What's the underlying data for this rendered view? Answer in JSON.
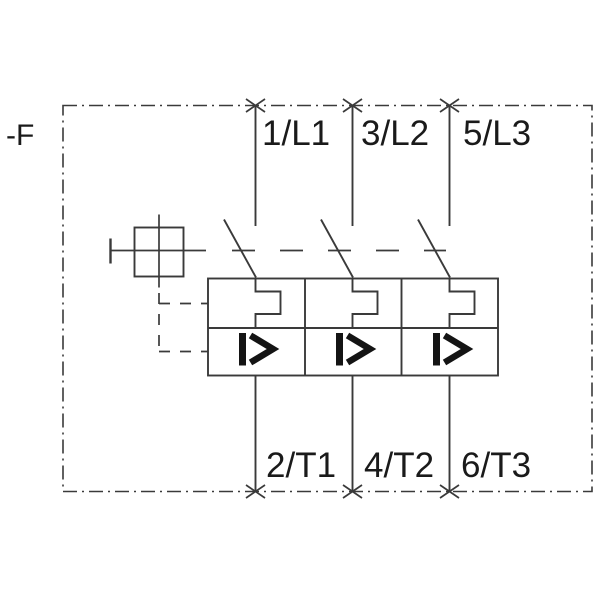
{
  "schematic": {
    "device_tag": "-F",
    "terminals": {
      "top": [
        {
          "label": "1/L1"
        },
        {
          "label": "3/L2"
        },
        {
          "label": "5/L3"
        }
      ],
      "bottom": [
        {
          "label": "2/T1"
        },
        {
          "label": "4/T2"
        },
        {
          "label": "6/T3"
        }
      ]
    },
    "poles": [
      {
        "line_terminal": "1/L1",
        "load_terminal": "2/T1",
        "release_symbol": "I>"
      },
      {
        "line_terminal": "3/L2",
        "load_terminal": "4/T2",
        "release_symbol": "I>"
      },
      {
        "line_terminal": "5/L3",
        "load_terminal": "6/T3",
        "release_symbol": "I>"
      }
    ],
    "icons": [
      {
        "name": "manual-operator-icon",
        "shape": "square-with-crosshair"
      },
      {
        "name": "mechanical-linkage-icon",
        "shape": "dashed-lines"
      },
      {
        "name": "thermal-overload-release-icon",
        "shape": "rectangular-hook"
      },
      {
        "name": "overcurrent-release-icon",
        "glyph": "I>"
      },
      {
        "name": "terminal-marker-icon",
        "glyph": "×"
      }
    ],
    "colors": {
      "background": "#ffffff",
      "line": "#3a3a3a",
      "text": "#1a1a1a",
      "symbol": "#141414"
    }
  }
}
